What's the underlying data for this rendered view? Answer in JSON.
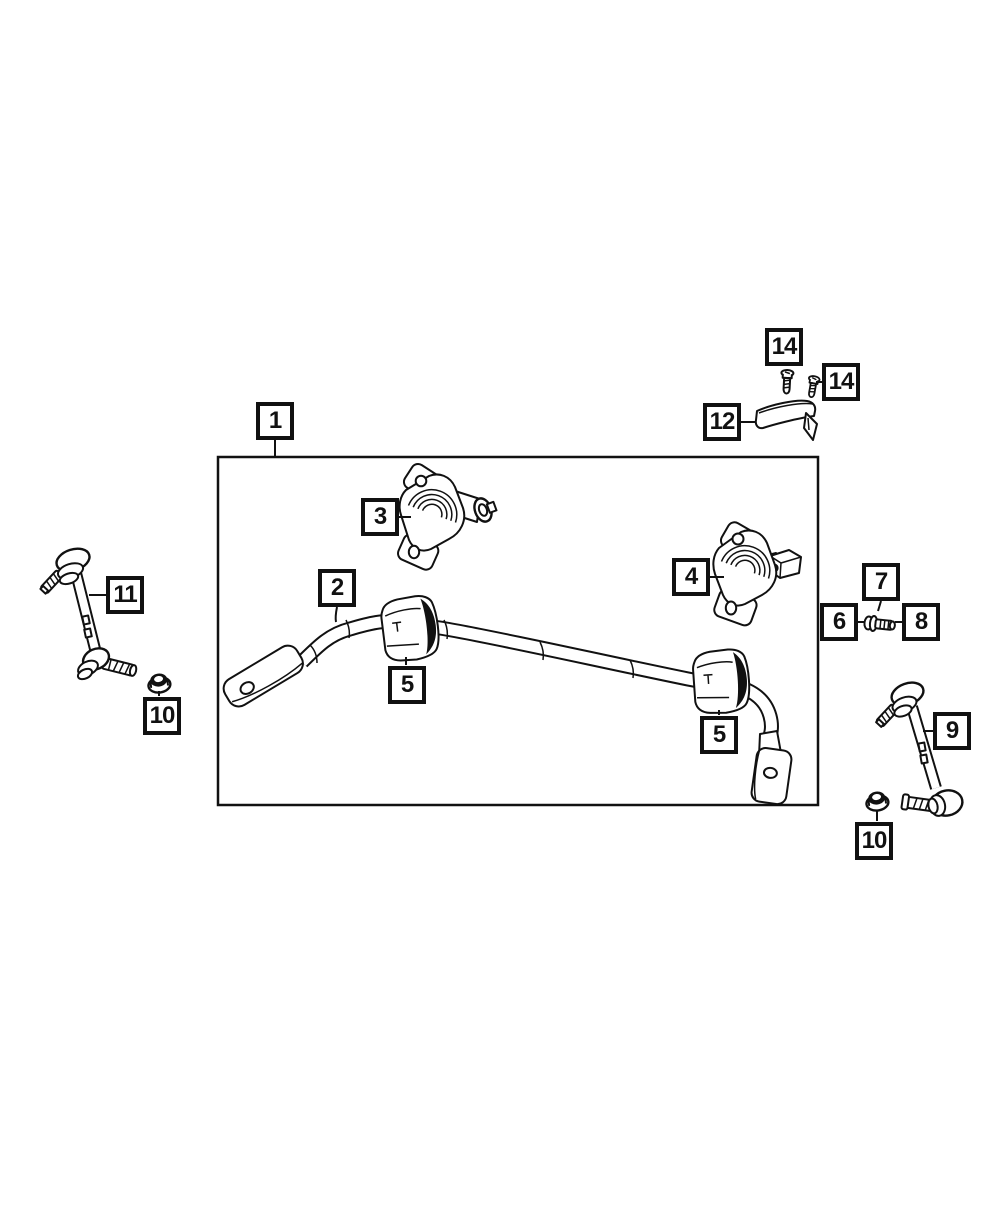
{
  "diagram": {
    "type": "exploded-parts-line-drawing",
    "colors": {
      "line": "#111111",
      "background": "#ffffff"
    }
  },
  "callouts": [
    {
      "id": "1",
      "label": "1"
    },
    {
      "id": "2",
      "label": "2"
    },
    {
      "id": "3",
      "label": "3"
    },
    {
      "id": "4",
      "label": "4"
    },
    {
      "id": "5a",
      "label": "5"
    },
    {
      "id": "5b",
      "label": "5"
    },
    {
      "id": "6",
      "label": "6"
    },
    {
      "id": "7",
      "label": "7"
    },
    {
      "id": "8",
      "label": "8"
    },
    {
      "id": "9",
      "label": "9"
    },
    {
      "id": "10a",
      "label": "10"
    },
    {
      "id": "10b",
      "label": "10"
    },
    {
      "id": "11",
      "label": "11"
    },
    {
      "id": "12",
      "label": "12"
    },
    {
      "id": "14a",
      "label": "14"
    },
    {
      "id": "14b",
      "label": "14"
    }
  ]
}
